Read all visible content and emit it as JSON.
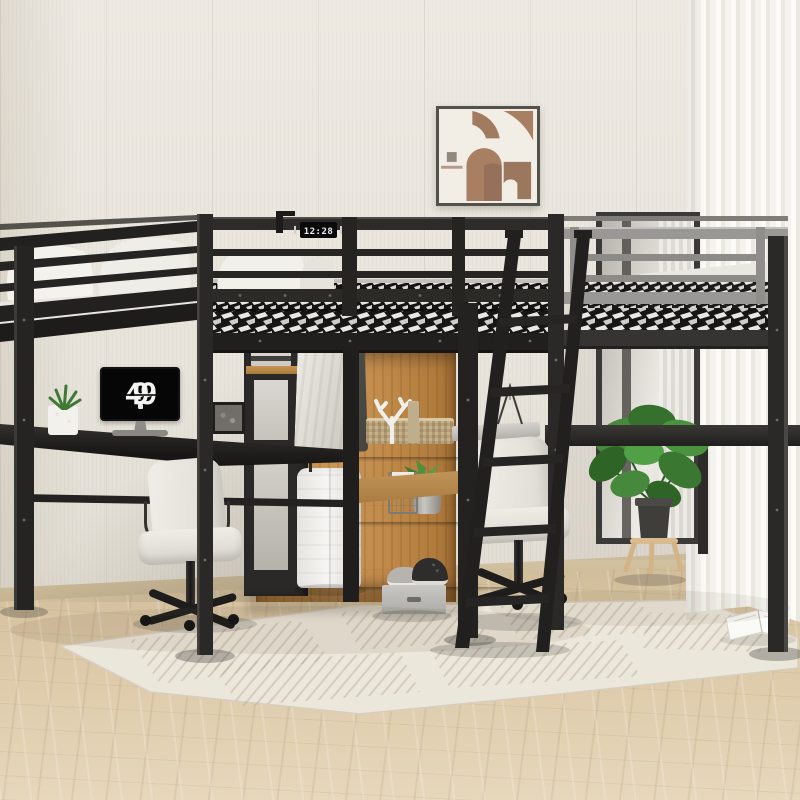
{
  "scene": {
    "clock_monitor": {
      "leading_dot": ".",
      "hours": "9",
      "minutes": "49"
    },
    "rail_clock": "12:28",
    "colors": {
      "wall": "#e9e5dd",
      "frame_black": "#2a2826",
      "rail_gray": "#9a9894",
      "wood_panel": "#c08a4f",
      "floor_wood": "#dcc9a9",
      "rug_cream": "#ece7db",
      "curtain_white": "#f5f3ee",
      "plant_green": "#44823a",
      "chair_white": "#efece6",
      "mattress_dark": "#141312",
      "mattress_light": "#e9e7e3",
      "art_brown": "#a87f63",
      "art_cream": "#f2eee5"
    },
    "objects": [
      "loft bed frame",
      "guard rails",
      "woven mattresses",
      "white bedding",
      "ladder",
      "corner desk",
      "flip clock monitor",
      "office chairs",
      "wardrobe with jackets",
      "clothes rod",
      "suitcase",
      "shelf bars",
      "wicker basket",
      "coral decor",
      "container cylinders",
      "book stack",
      "succulent plant",
      "wire basket",
      "sneakers",
      "storage box",
      "monstera plant",
      "plant stand",
      "abstract wall art",
      "leaning mirror",
      "sheer curtain",
      "area rug",
      "open book",
      "photo frame",
      "white planter"
    ]
  }
}
